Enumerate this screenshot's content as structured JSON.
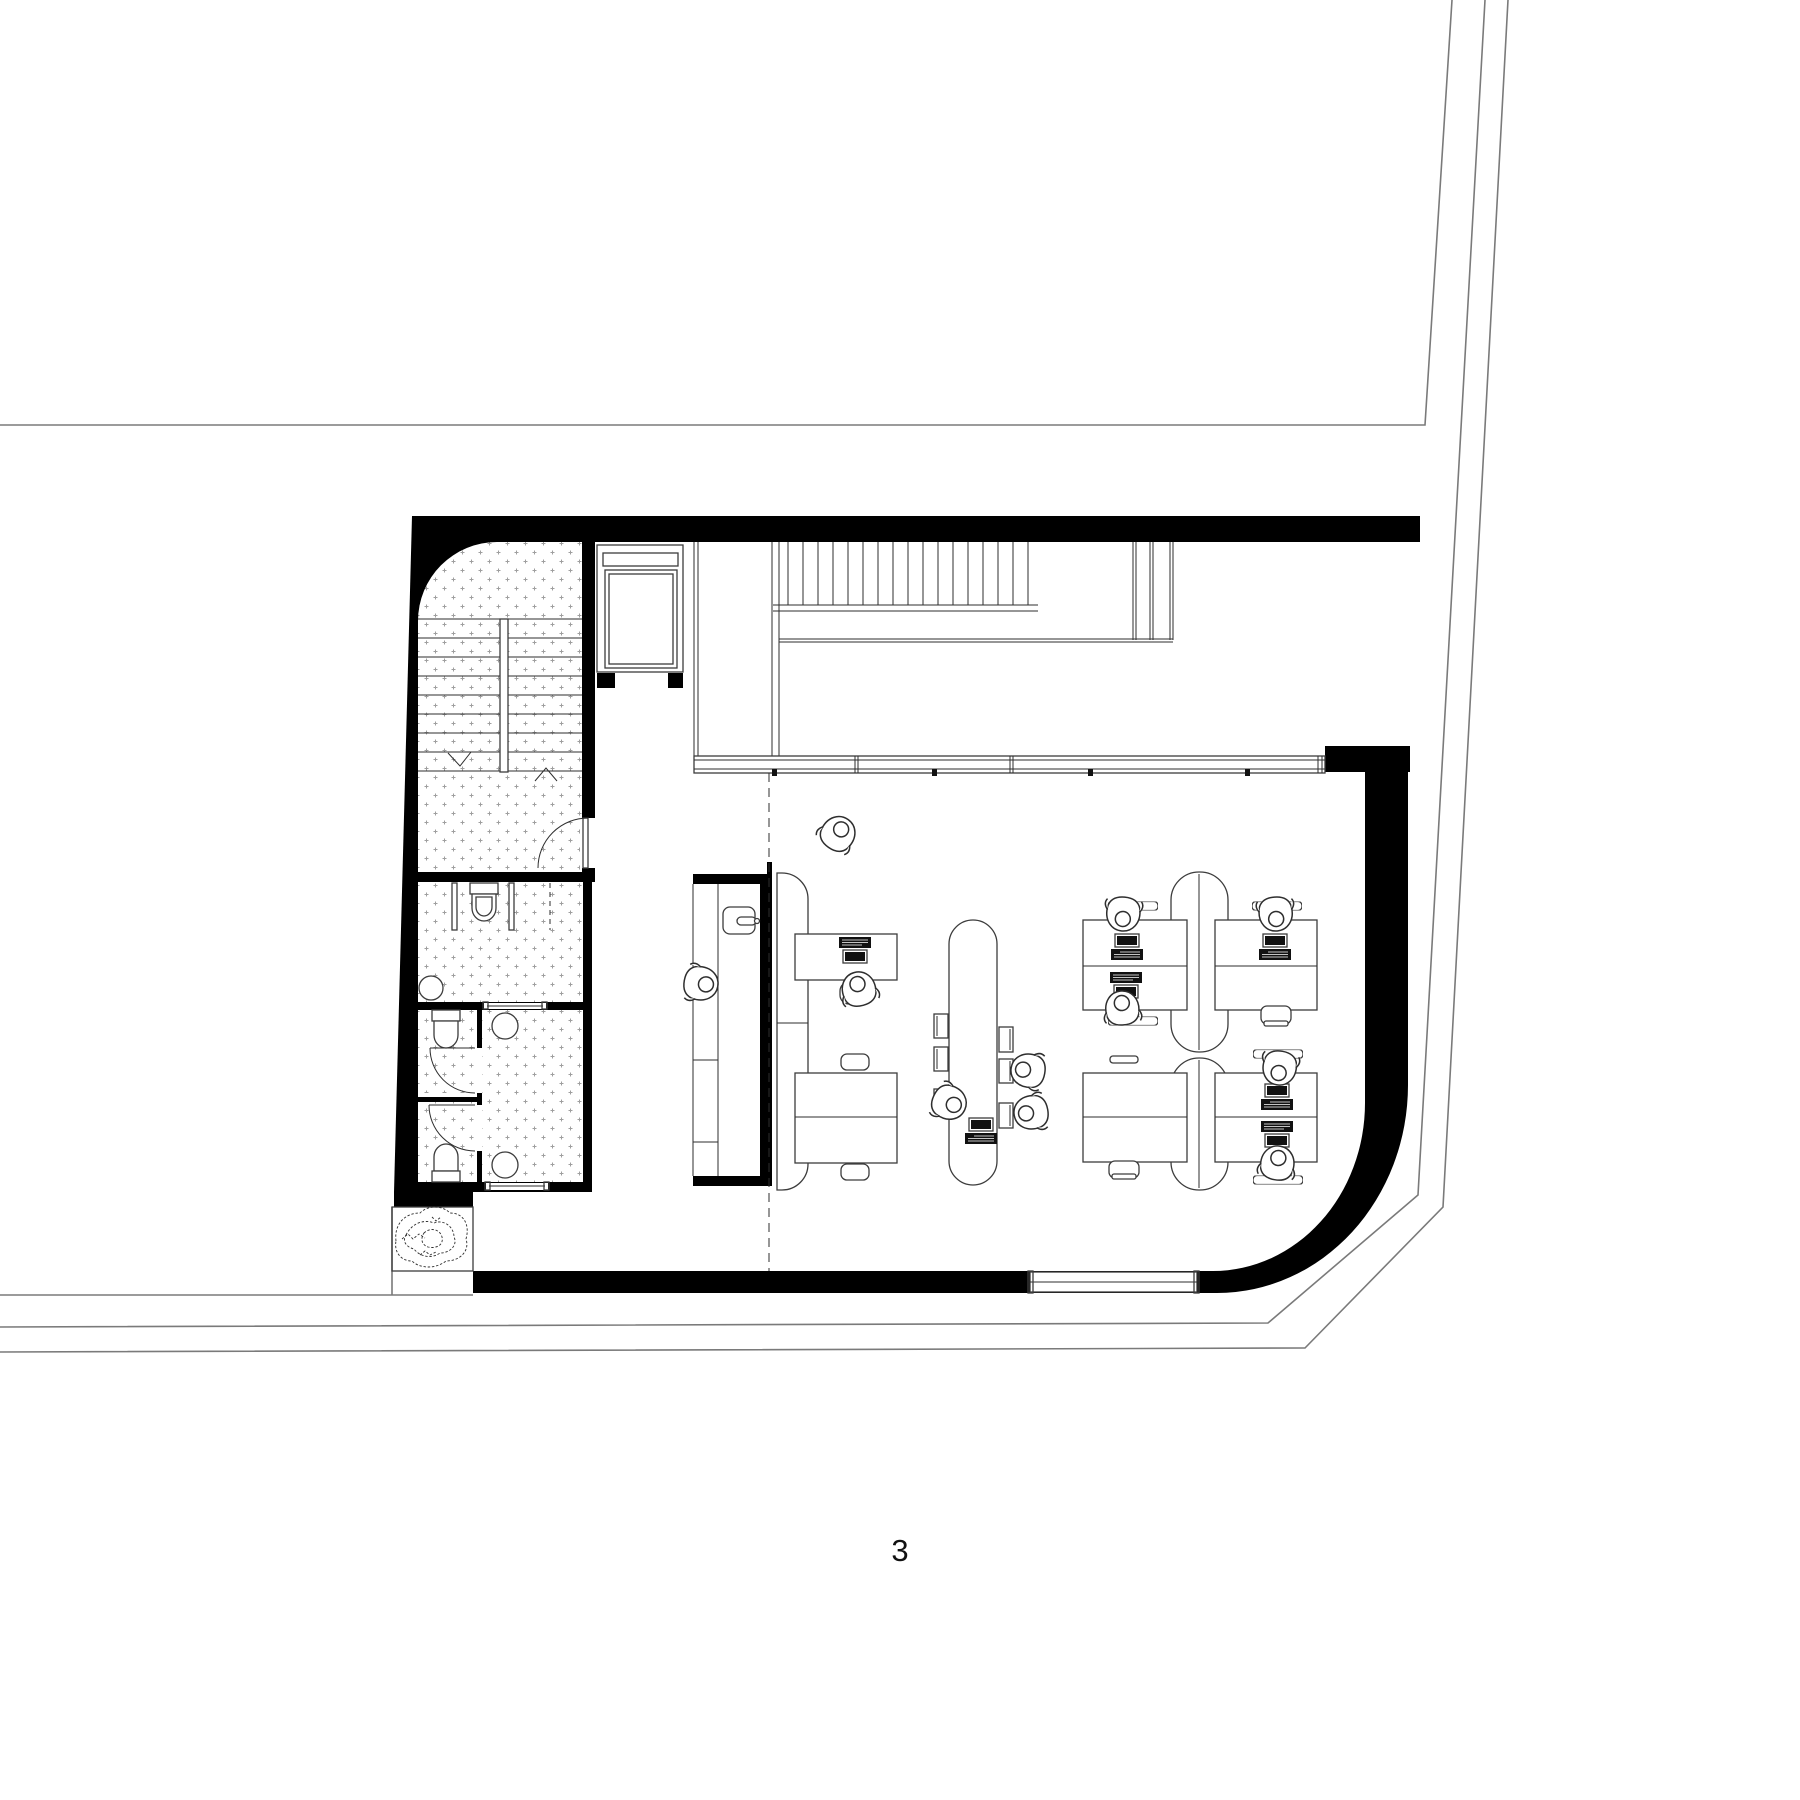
{
  "plan": {
    "floor_label": "3"
  },
  "colors": {
    "background": "#ffffff",
    "wall": "#000000",
    "ink": "#2e2e2e",
    "furniture_line": "#3c3c3c",
    "site_line": "#7a7a7a",
    "stipple": "#9f9f9f",
    "monitor": "#111111"
  }
}
